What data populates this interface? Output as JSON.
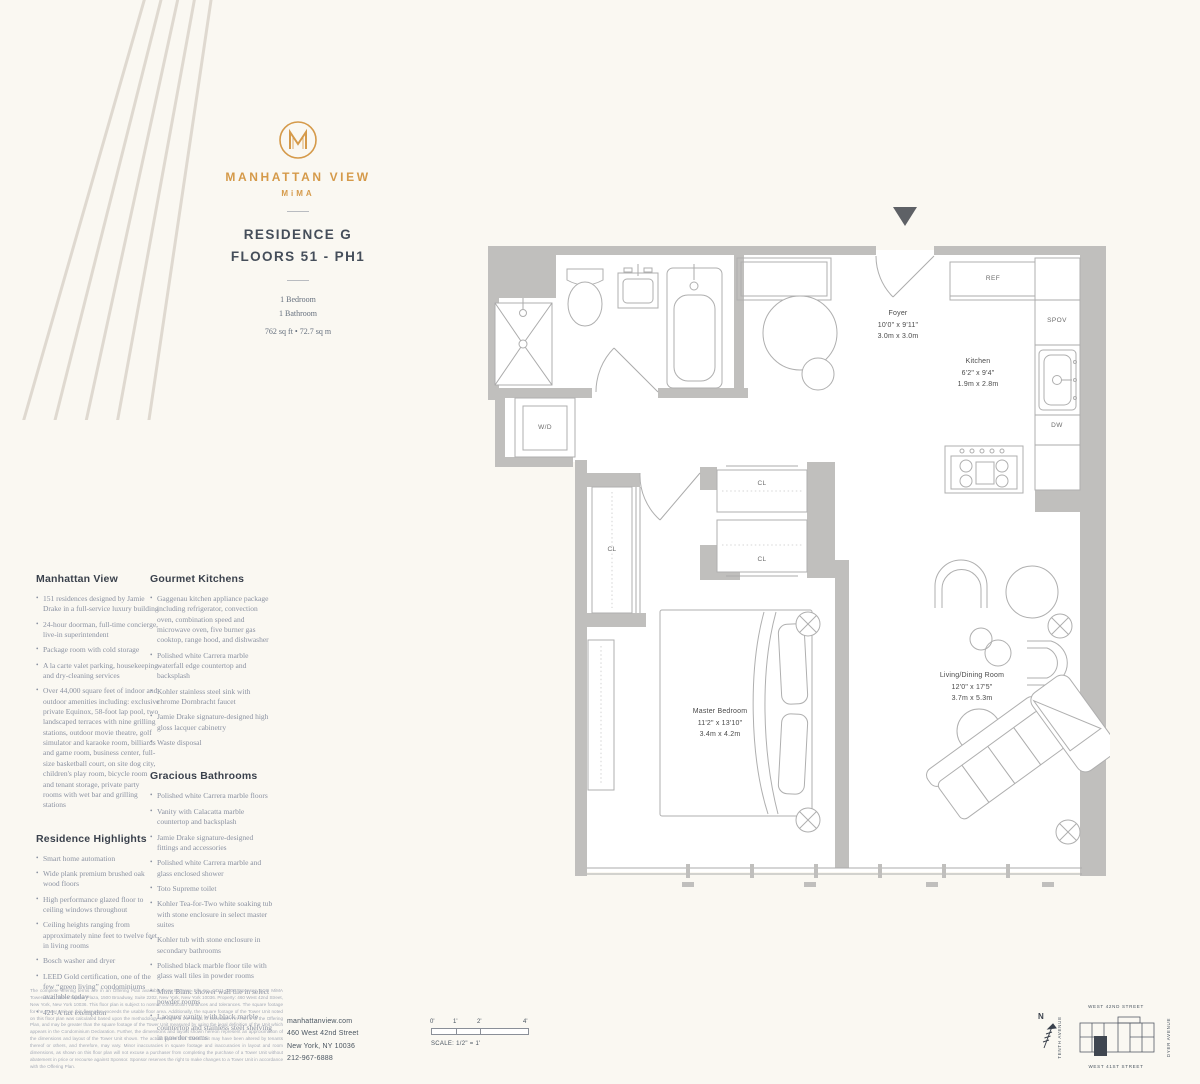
{
  "brand": {
    "name": "MANHATTAN VIEW",
    "sub": "MiMA",
    "monogram": "M"
  },
  "residence": {
    "title_line1": "RESIDENCE G",
    "title_line2": "FLOORS 51 - PH1",
    "bedrooms": "1 Bedroom",
    "bathrooms": "1 Bathroom",
    "area": "762 sq ft • 72.7 sq m"
  },
  "columns": {
    "sections": [
      {
        "heading": "Manhattan View",
        "bullets": [
          "151 residences designed by Jamie Drake in a full-service luxury building",
          "24-hour doorman, full-time concierge, live-in superintendent",
          "Package room with cold storage",
          "A la carte valet parking, housekeeping and dry-cleaning services",
          "Over 44,000 square feet of indoor and outdoor amenities including: exclusive private Equinox, 58-foot lap pool, two landscaped terraces with nine grilling stations, outdoor movie theatre, golf simulator and karaoke room, billiards and game room, business center, full-size basketball court, on site dog city, children's play room, bicycle room and tenant storage, private party rooms with wet bar and grilling stations"
        ]
      },
      {
        "heading": "Residence Highlights",
        "bullets": [
          "Smart home automation",
          "Wide plank premium brushed oak wood floors",
          "High performance glazed floor to ceiling windows throughout",
          "Ceiling heights ranging from approximately nine feet to twelve feet in living rooms",
          "Bosch washer and dryer",
          "LEED Gold certification, one of the few “green living” condominiums available today",
          "421-A tax exemption"
        ]
      },
      {
        "heading": "Gourmet Kitchens",
        "bullets": [
          "Gaggenau kitchen appliance package including refrigerator, convection oven, combination speed and microwave oven, five burner gas cooktop, range hood, and dishwasher",
          "Polished white Carrera marble waterfall edge countertop and backsplash",
          "Kohler stainless steel sink with chrome Dornbracht faucet",
          "Jamie Drake signature-designed high gloss lacquer cabinetry",
          "Waste disposal"
        ]
      },
      {
        "heading": "Gracious Bathrooms",
        "bullets": [
          "Polished white Carrera marble floors",
          "Vanity with Calacatta marble countertop and backsplash",
          "Jamie Drake signature-designed fittings and accessories",
          "Polished white Carrera marble and glass enclosed shower",
          "Toto Supreme toilet",
          "Kohler Tea-for-Two white soaking tub with stone enclosure in select master suites",
          "Kohler tub with stone enclosure in secondary bathrooms",
          "Polished black marble floor tile with glass wall tiles in powder rooms",
          "Mont Blanc shower wall tile in select powder rooms",
          "Lacquer vanity with black marble countertop and stainless steel shelving in powder rooms"
        ]
      }
    ]
  },
  "plan": {
    "rooms": [
      {
        "name": "Foyer",
        "imperial": "10'0\" x 9'11\"",
        "metric": "3.0m x 3.0m"
      },
      {
        "name": "Kitchen",
        "imperial": "6'2\" x 9'4\"",
        "metric": "1.9m x 2.8m"
      },
      {
        "name": "Master Bedroom",
        "imperial": "11'2\" x 13'10\"",
        "metric": "3.4m x 4.2m"
      },
      {
        "name": "Living/Dining Room",
        "imperial": "12'0\" x 17'5\"",
        "metric": "3.7m x 5.3m"
      }
    ],
    "labels": {
      "wd": "W/D",
      "ref": "REF",
      "spov": "SPOV",
      "dw": "DW",
      "cl": "CL"
    }
  },
  "footer": {
    "disclaimer": "The complete offering terms are in an Offering Plan available from Sponsor. File No. CD11-0200. Sponsor: SCG MiMA Towers LLC, Times Square Plaza, 1500 Broadway, Suite 2202, New York, New York 10036. Property: 460 West 42nd Street, New York, New York 10036. This floor plan is subject to normal construction variances and tolerances. The square footage for the Tower Unit on this floor plan exceeds the usable floor area. Additionally, the square footage of the Tower Unit noted on this floor plan was calculated based upon the methodology set forth in the Notes to Schedule A in Part 1 of the Offering Plan, and may be greater than the square footage of the Tower Unit measured by using the legal definition of the Unit which appears in the Condominium Declaration. Further, the dimensions and layout shown hereon represent an approximation of the dimensions and layout of the Tower Unit shown. The actual layout of a Tower Unit may have been altered by tenants thereof or others, and therefore, may vary. Minor inaccuracies in square footage and inaccuracies in layout and room dimensions, as shown on this floor plan will not excuse a purchaser from completing the purchase of a Tower Unit without abatement in price or recourse against Sponsor. Sponsor reserves the right to make changes to a Tower Unit in accordance with the Offering Plan.",
    "contact": {
      "website": "manhattanview.com",
      "address1": "460 West 42nd Street",
      "address2": "New York, NY 10036",
      "phone": "212-967-6888"
    },
    "scale": {
      "ticks": [
        "0'",
        "1'",
        "2'",
        "4'"
      ],
      "label": "SCALE: 1/2\" = 1'"
    },
    "map": {
      "north": "N",
      "street_top": "WEST 42ND STREET",
      "street_bottom": "WEST 41ST STREET",
      "ave_left": "TENTH AVENUE",
      "ave_right": "DYER AVENUE"
    }
  },
  "colors": {
    "accent_orange": "#D59A4A",
    "wall_gray": "#C0BFBD",
    "ink": "#3A414C",
    "background": "#FAF8F2"
  }
}
